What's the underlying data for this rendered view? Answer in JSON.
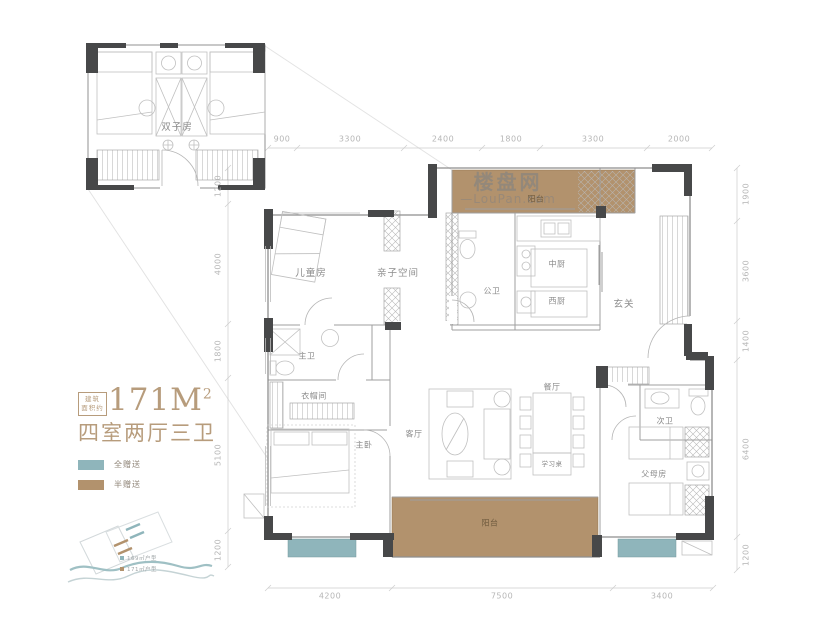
{
  "watermark": {
    "brand": "楼盘网",
    "site": "—LouPan.com"
  },
  "title": {
    "area_note": [
      "建筑",
      "面积约"
    ],
    "area_value": "171M",
    "area_sup": "2",
    "layout": "四室两厅三卫"
  },
  "legend": {
    "full_gift": {
      "label": "全赠送",
      "color": "#8fb5bb"
    },
    "half_gift": {
      "label": "半赠送",
      "color": "#b2926d"
    }
  },
  "rooms": {
    "twin_room": "双子房",
    "kids_room": "儿童房",
    "family_space": "亲子空间",
    "guest_bath": "公卫",
    "chinese_kitchen": "中厨",
    "western_kitchen": "西厨",
    "foyer": "玄关",
    "balcony_top": "阳台",
    "master_bath": "主卫",
    "cloakroom": "衣帽间",
    "master_bedroom": "主卧",
    "living_room": "客厅",
    "dining_room": "餐厅",
    "study_desk": "学习桌",
    "balcony_bottom": "阳台",
    "second_bath": "次卫",
    "parents_room": "父母房"
  },
  "dims": {
    "top": [
      "900",
      "3300",
      "2400",
      "1800",
      "3300",
      "2000"
    ],
    "left": [
      "1200",
      "4000",
      "1800",
      "5100",
      "1200"
    ],
    "right": [
      "1900",
      "3600",
      "1400",
      "6400",
      "1200"
    ],
    "bottom": [
      "4200",
      "7500",
      "3400"
    ]
  },
  "thumbnail": {
    "captions": [
      "169㎡户型",
      "171㎡户型"
    ]
  }
}
